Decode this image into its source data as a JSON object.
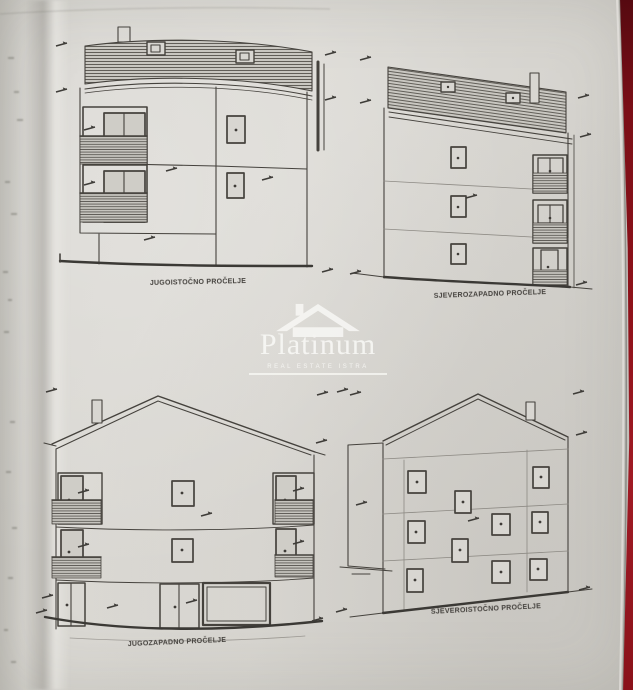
{
  "sheet": {
    "captions": {
      "top_left": "JUGOISTOČNO PROČELJE",
      "top_right": "SJEVEROZAPADNO PROČELJE",
      "bottom_left": "JUGOZAPADNO PROČELJE",
      "bottom_right": "SJEVEROISTOČNO PROČELJE"
    }
  },
  "watermark": {
    "brand": "Platinum",
    "tagline": "REAL ESTATE ISTRA"
  },
  "colors": {
    "paper": "#d8d6d1",
    "ink": "#45423d",
    "red_edge": "#8e1119",
    "watermark": "#fafaf7"
  }
}
